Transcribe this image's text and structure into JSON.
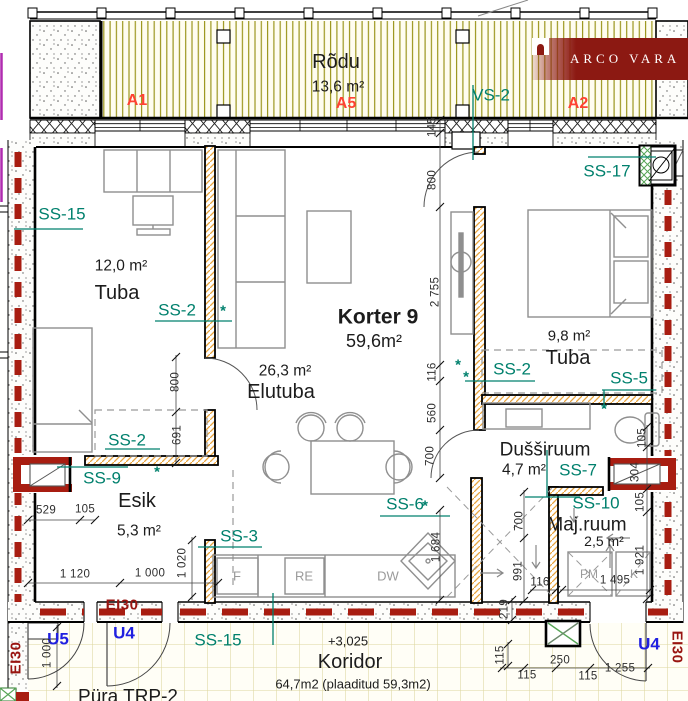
{
  "brand": {
    "name": "ARCO VARA"
  },
  "colors": {
    "teal": "#00806d",
    "zone_red": "#ff4233",
    "fire_red": "#a81d11",
    "door_blue": "#2020e0",
    "deck_line": "#9c961e",
    "tile_line": "#dcd79e",
    "hatch_orange": "#e8a33d",
    "hatch_green": "#57a557"
  },
  "balcony": {
    "name": "Rõdu",
    "area": "13,6 m²",
    "zone_a1": "A1",
    "zone_a5": "A5",
    "zone_a2": "A2"
  },
  "apartment": {
    "name": "Korter 9",
    "area": "59,6m²"
  },
  "rooms": {
    "tuba_left": {
      "area": "12,0 m²",
      "name": "Tuba"
    },
    "elutuba": {
      "area": "26,3 m²",
      "name": "Elutuba"
    },
    "tuba_right": {
      "area": "9,8 m²",
      "name": "Tuba"
    },
    "dussiruum": {
      "name": "Dušširuum",
      "area": "4,7 m²"
    },
    "majruum": {
      "name": "Maj.ruum",
      "area": "2,5 m²"
    },
    "esik": {
      "name": "Esik",
      "area": "5,3 m²"
    },
    "koridor": {
      "name": "Koridor",
      "area_note": "64,7m2 (plaaditud 59,3m2)"
    }
  },
  "tags": {
    "vs2": "VS-2",
    "ss15_tuba": "SS-15",
    "ss2_tuba": "SS-2",
    "ss2_esik": "SS-2",
    "ss9": "SS-9",
    "ss3": "SS-3",
    "ss6": "SS-6",
    "ss2_tuba2": "SS-2",
    "ss5": "SS-5",
    "ss17": "SS-17",
    "ss7": "SS-7",
    "ss10": "SS-10",
    "ss15_koridor": "SS-15"
  },
  "doors": {
    "u5": "U5",
    "u4_left": "U4",
    "u4_right": "U4"
  },
  "fire": {
    "ei30_bottom": "EI30",
    "ei30_left": "EI30",
    "ei30_right": "EI30"
  },
  "appliances": {
    "fridge": "F",
    "re": "RE",
    "dw": "DW",
    "pm": "PM",
    "k": "K"
  },
  "dims": {
    "esik_h_800": "800",
    "esik_h_691": "691",
    "w529": "529",
    "w105": "105",
    "w1120": "1 120",
    "w1000": "1 000",
    "h1020": "1 020",
    "c145": "145",
    "c800": "800",
    "c2755": "2 755",
    "c116": "116",
    "c560": "560",
    "c700": "700",
    "c1684": "1 684",
    "d700": "700",
    "d991": "991",
    "d116": "116",
    "d1495": "1 495",
    "d1921": "1 921",
    "r105a": "105",
    "r304": "304",
    "r105b": "105",
    "k1000": "1 000",
    "k219": "219",
    "k115a": "115",
    "k250": "250",
    "k115b": "115",
    "k115c": "115",
    "k1255": "1 255"
  },
  "marks": {
    "asterisk": "*",
    "level": "+3,025",
    "bottom_label": "Püra TRP-2"
  }
}
